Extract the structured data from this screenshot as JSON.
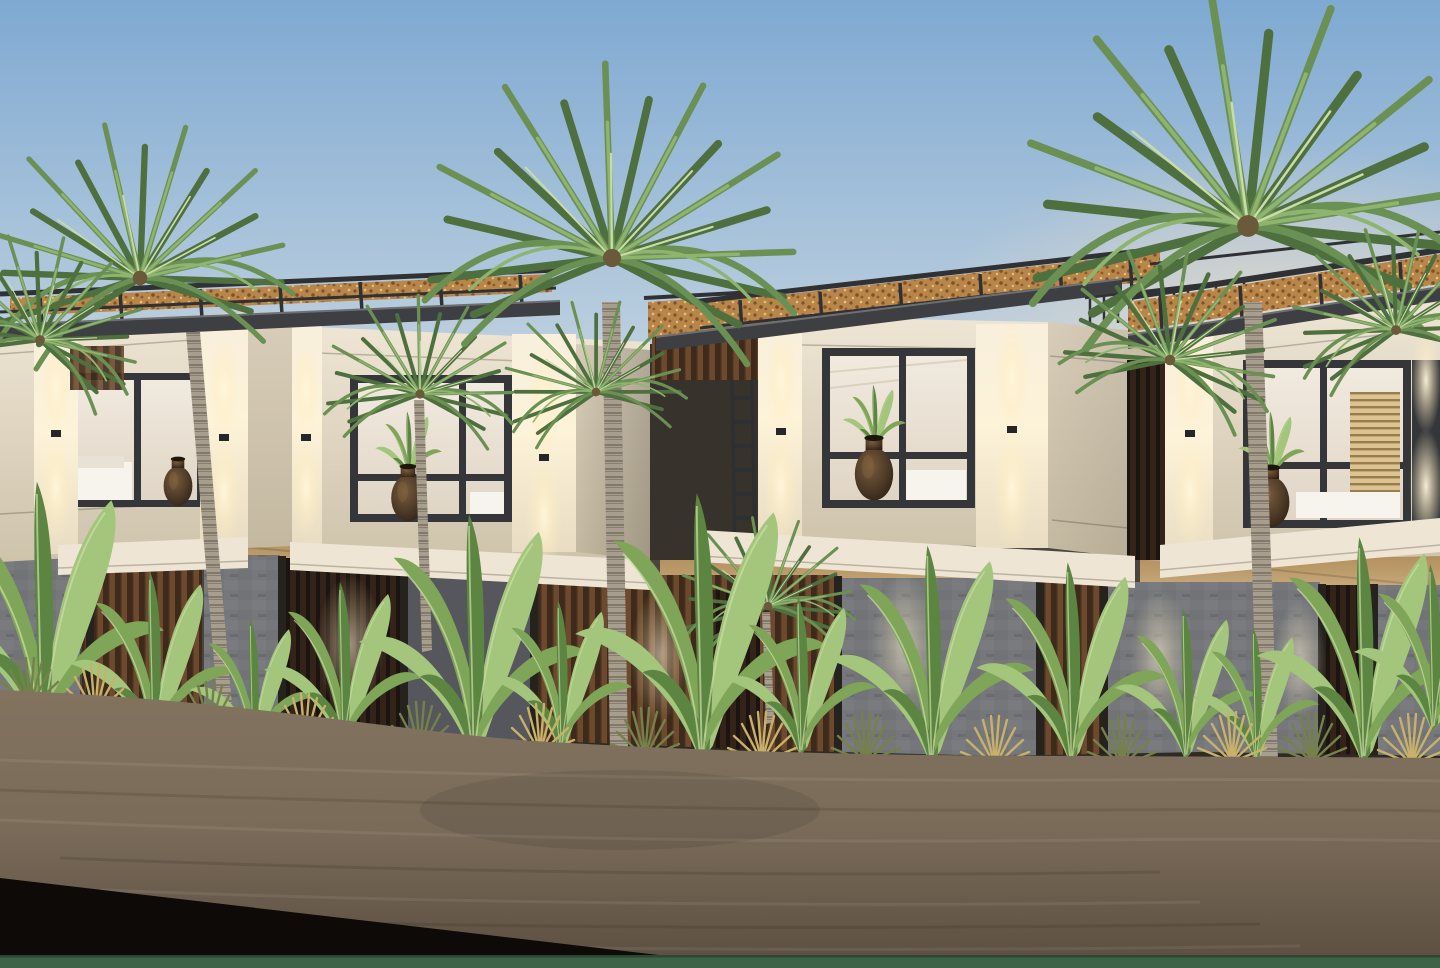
{
  "scene": {
    "title": "Dusk architectural rendering of a row of modern tropical two-storey villas with fan palms and banana plants",
    "type": "3d-architectural-rendering",
    "time_of_day": "dusk",
    "villa_count": 4,
    "features": [
      "cream limestone upper-floor boxes with warm wall-washer lighting",
      "large dark-framed picture windows with lit interiors, beds and decorative vases",
      "flat dark roof slabs with timber-and-rattan pergola canopies",
      "recessed grey stone and timber-slat ground floors with warm soffit lighting",
      "metal access ladder between two villas",
      "tall fan palm trees and banana plants along a planted border",
      "bare earth foreground with dark shadow wedge and low green hedge strip at bottom"
    ]
  },
  "colors": {
    "sky_top": "#7fa9d2",
    "sky_mid": "#b9cdde",
    "sky_low": "#e4e8ea",
    "sky_horizon": "#f1e9dc",
    "haze_warm": "#f2ddc2",
    "facade_light": "#eee5d4",
    "facade": "#e0d6c3",
    "facade_dark": "#cec3ab",
    "facade_side": "#d8cdb8",
    "pier_glow": "#fdf3d9",
    "roof_dark": "#3d3f42",
    "metal": "#2f3134",
    "rattan": "#b8854a",
    "rattan_dark": "#7d5226",
    "rattan_light": "#e5c07a",
    "frame": "#34363a",
    "interior": "#f1eadf",
    "bed_white": "#f7f4ed",
    "soffit": "#cfb386",
    "soffit_deep": "#a8824f",
    "stone": "#75777b",
    "stone_dark": "#55575c",
    "timber": "#6d4a2e",
    "timber_dark": "#3e2a1a",
    "recess": "#37332c",
    "vase": "#4d3a28",
    "vase_dark": "#2f2115",
    "trunk": "#a89e8e",
    "trunk_dark": "#7b7264",
    "palm_dark": "#4e6f3e",
    "palm_mid": "#6b9053",
    "palm_light": "#8fb470",
    "palm_pale": "#c8dca8",
    "banana": "#7fa558",
    "banana_light": "#a3c57c",
    "banana_dark": "#5d8542",
    "grass_lit": "#c8b169",
    "grass_green": "#75814a",
    "planter": "#2e2a24",
    "dirt": "#7a6b59",
    "dirt_dark": "#5b4e40",
    "dirt_light": "#82735f",
    "shadow": "#0d0a07",
    "hedge": "#3e6347"
  },
  "elements": [
    {
      "name": "villa-a",
      "label": "left villa (partially cropped), lit window with bed and jar vase"
    },
    {
      "name": "villa-b",
      "label": "left-centre villa, window with houseplant vase, access ladder on right"
    },
    {
      "name": "villa-c",
      "label": "centre villa, corner window with houseplant vase, blank side wall"
    },
    {
      "name": "villa-d",
      "label": "right villa, window with slatted blinds, vase on balcony ledge"
    },
    {
      "name": "palm-tree-1",
      "label": "fan palm in front of left villa"
    },
    {
      "name": "palm-tree-2",
      "label": "small fan palm over left-centre window"
    },
    {
      "name": "palm-tree-3",
      "label": "tall central fan palm"
    },
    {
      "name": "palm-tree-4",
      "label": "low palm crown at centre ground floor"
    },
    {
      "name": "palm-tree-5",
      "label": "large fan palm in front of right villa"
    },
    {
      "name": "banana-grove",
      "label": "banana plants and ornamental grasses along planted border"
    },
    {
      "name": "dirt-ground",
      "label": "bare earth foreground"
    },
    {
      "name": "ground-shadow-wedge",
      "label": "dark shadow wedge at bottom left"
    },
    {
      "name": "hedge-strip",
      "label": "low green hedge strip across the bottom edge"
    }
  ]
}
